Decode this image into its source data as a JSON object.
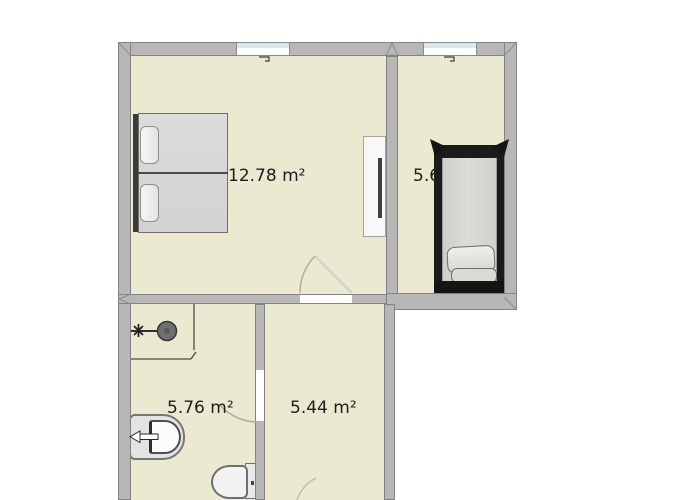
{
  "floorplan": {
    "title": "apartment-floor-plan",
    "rooms": [
      {
        "name": "bedroom-large",
        "area_label": "12.78 m²"
      },
      {
        "name": "bedroom-small",
        "area_label": "5.6"
      },
      {
        "name": "bathroom",
        "area_label": "5.76 m²"
      },
      {
        "name": "hallway",
        "area_label": "5.44 m²"
      }
    ],
    "furniture": [
      {
        "name": "double-bed",
        "room": "bedroom-large"
      },
      {
        "name": "wardrobe",
        "room": "bedroom-large"
      },
      {
        "name": "single-bed",
        "room": "bedroom-small"
      },
      {
        "name": "shower",
        "room": "bathroom"
      },
      {
        "name": "sink",
        "room": "bathroom"
      },
      {
        "name": "toilet",
        "room": "bathroom"
      }
    ],
    "openings": {
      "windows": 2,
      "doors": 3
    },
    "colors": {
      "floor": "#ebe9cf",
      "wall": "#b7b7b7",
      "wall_edge": "#828282",
      "outside": "#ffffff",
      "window_glass": "#d9e8ef",
      "door_arc": "#b3aa8c",
      "label_text": "#1d1d1d"
    }
  }
}
